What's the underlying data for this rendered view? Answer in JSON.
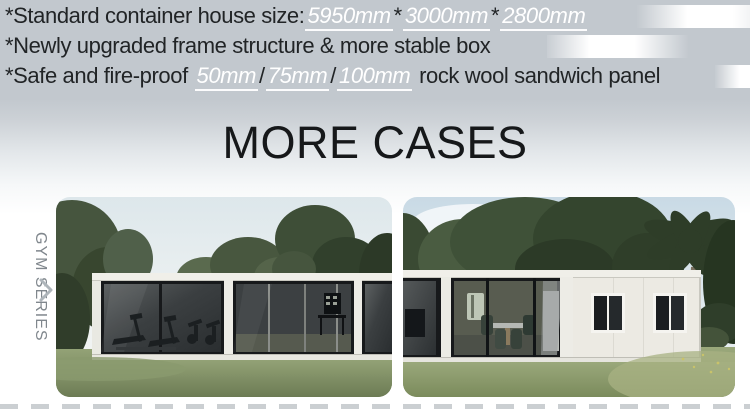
{
  "banner": {
    "features": [
      {
        "segments": [
          {
            "text": "*Standard container house size:"
          },
          {
            "text": "5950mm",
            "em": true
          },
          {
            "text": "*"
          },
          {
            "text": "3000mm",
            "em": true
          },
          {
            "text": "*"
          },
          {
            "text": "2800mm",
            "em": true
          }
        ]
      },
      {
        "segments": [
          {
            "text": "*Newly upgraded frame structure & more stable box"
          }
        ]
      },
      {
        "segments": [
          {
            "text": "*Safe and fire-proof "
          },
          {
            "text": "50mm",
            "em": true
          },
          {
            "text": "/"
          },
          {
            "text": "75mm",
            "em": true
          },
          {
            "text": "/"
          },
          {
            "text": "100mm",
            "em": true
          },
          {
            "text": " rock wool sandwich panel"
          }
        ]
      }
    ]
  },
  "heading": {
    "title": "MORE CASES"
  },
  "series_rail": {
    "label": "GYM SERIES",
    "icon": "chevron-right-icon"
  },
  "cases": [
    {
      "alt": "Flat-pack container gym with full glass walls and treadmills inside, lawn and trees behind"
    },
    {
      "alt": "Container gym with glass dining area and white panel wall with two window pairs, palm trees behind"
    }
  ],
  "colors": {
    "banner_background": "#c2c8ce",
    "text_dark": "#212426",
    "highlight_white": "#ffffff",
    "series_label_gray": "#80878d",
    "chevron_gray": "#aeb5ba",
    "dashed_divider": "#cbcfd2"
  }
}
